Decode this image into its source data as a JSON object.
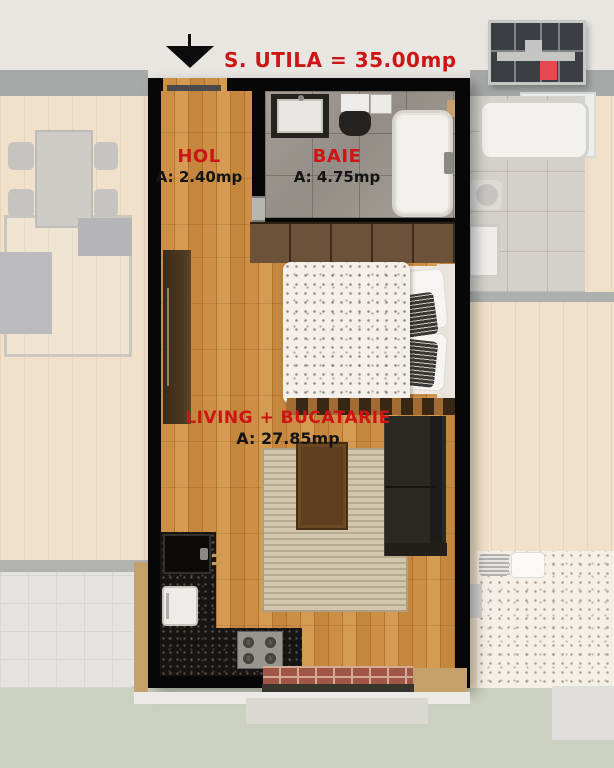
{
  "title": {
    "marker_icon": "down-arrow",
    "text": "S. UTILA = 35.00mp"
  },
  "rooms": [
    {
      "name": "HOL",
      "area": "A: 2.40mp"
    },
    {
      "name": "BAIE",
      "area": "A: 4.75mp"
    },
    {
      "name": "LIVING + BUCATARIE",
      "area": "A: 27.85mp"
    }
  ],
  "logo": {
    "icon": "building-cross-section-logo",
    "bg": "#3b3e42",
    "accent_red": "#e64750",
    "frame": "#c7c7c5"
  },
  "colors": {
    "accent_red": "#cd1515",
    "label_black": "#141414",
    "wall_black": "#070707",
    "wood_floor": "#c98c41",
    "bathroom_tile": "#9d968f",
    "background": "#e9e6e2",
    "grass": "#cbd1c1",
    "neighbor_floor_faded": "#f2e1ca"
  }
}
